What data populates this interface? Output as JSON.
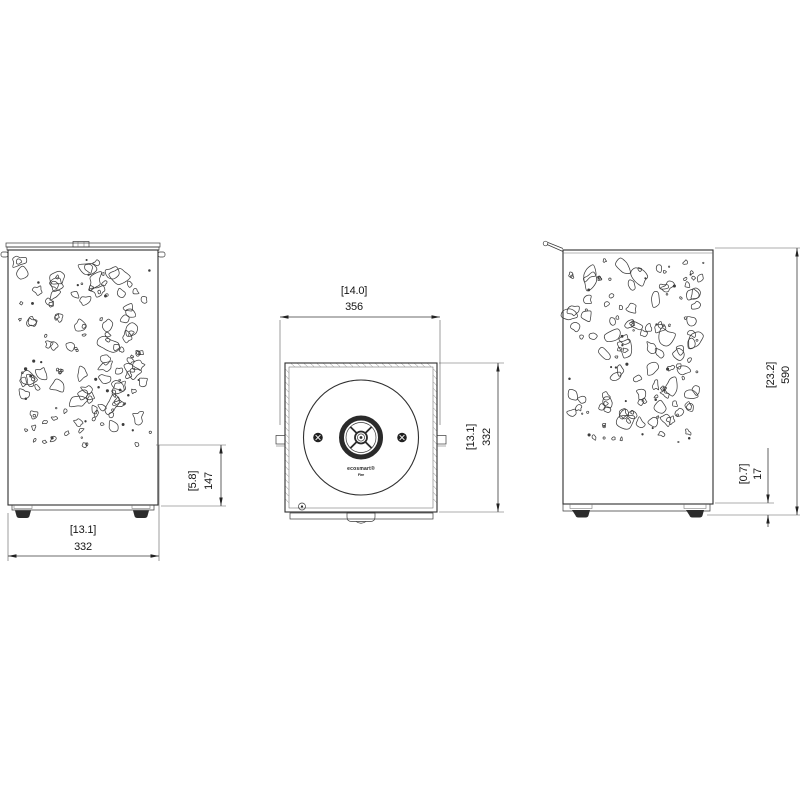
{
  "colors": {
    "background": "#ffffff",
    "ink": "#333333",
    "dimension_text": "#151515"
  },
  "logo": {
    "brand": "ecosmart®",
    "sub": "Fire"
  },
  "views": {
    "front": {
      "dim_plain_band": {
        "inches": "[5.8]",
        "mm": "147"
      },
      "dim_width": {
        "inches": "[13.1]",
        "mm": "332"
      }
    },
    "top": {
      "dim_width": {
        "inches": "[14.0]",
        "mm": "356"
      },
      "dim_depth": {
        "inches": "[13.1]",
        "mm": "332"
      }
    },
    "side": {
      "dim_height": {
        "inches": "[23.2]",
        "mm": "590"
      },
      "dim_foot": {
        "inches": "[0.7]",
        "mm": "17"
      }
    }
  }
}
